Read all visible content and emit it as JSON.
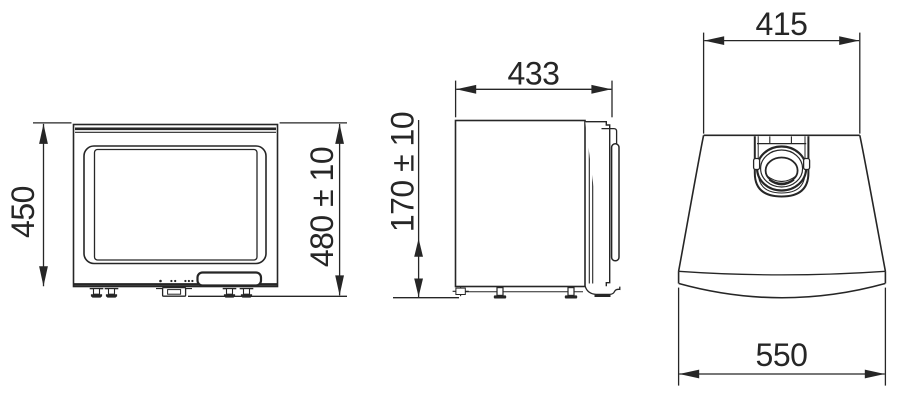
{
  "colors": {
    "background": "#ffffff",
    "line": "#262626",
    "text": "#262626"
  },
  "dimensions": {
    "front_height": "450",
    "front_total_height": "480 ± 10",
    "side_depth": "433",
    "side_bottom_height": "170 ± 10",
    "top_back_width": "415",
    "top_front_width": "550"
  }
}
